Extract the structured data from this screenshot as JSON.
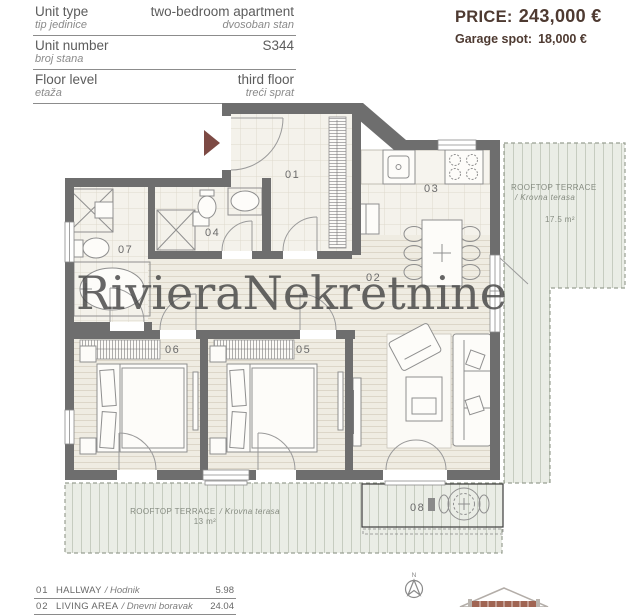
{
  "header": {
    "rows": [
      {
        "label": "Unit type",
        "sublabel": "tip jedinice",
        "value": "two-bedroom apartment",
        "subvalue": "dvosoban stan"
      },
      {
        "label": "Unit number",
        "sublabel": "broj stana",
        "value": "S344",
        "subvalue": ""
      },
      {
        "label": "Floor level",
        "sublabel": "etaža",
        "value": "third floor",
        "subvalue": "treći sprat"
      }
    ]
  },
  "price": {
    "label": "PRICE:",
    "value": "243,000 €",
    "garage_label": "Garage spot:",
    "garage_value": "18,000 €",
    "accent_color": "#4e3a31"
  },
  "plan": {
    "watermark": "RivieraNekretnine",
    "rooms": {
      "r01": "01",
      "r02": "02",
      "r03": "03",
      "r04": "04",
      "r05": "05",
      "r06": "06",
      "r07": "07",
      "r08": "08"
    },
    "terrace_right": {
      "title": "ROOFTOP TERRACE",
      "subtitle": "/ Krovna terasa",
      "area": "17.5 m²"
    },
    "terrace_bottom": {
      "title": "ROOFTOP TERRACE",
      "subtitle": "/ Krovna terasa",
      "area": "13 m²"
    },
    "compass": {
      "label": "N"
    }
  },
  "legend": {
    "items": [
      {
        "num": "01",
        "name": "HALLWAY",
        "localized": "/ Hodnik",
        "area": "5.98"
      },
      {
        "num": "02",
        "name": "LIVING AREA",
        "localized": "/ Dnevni boravak",
        "area": "24.04"
      }
    ]
  }
}
